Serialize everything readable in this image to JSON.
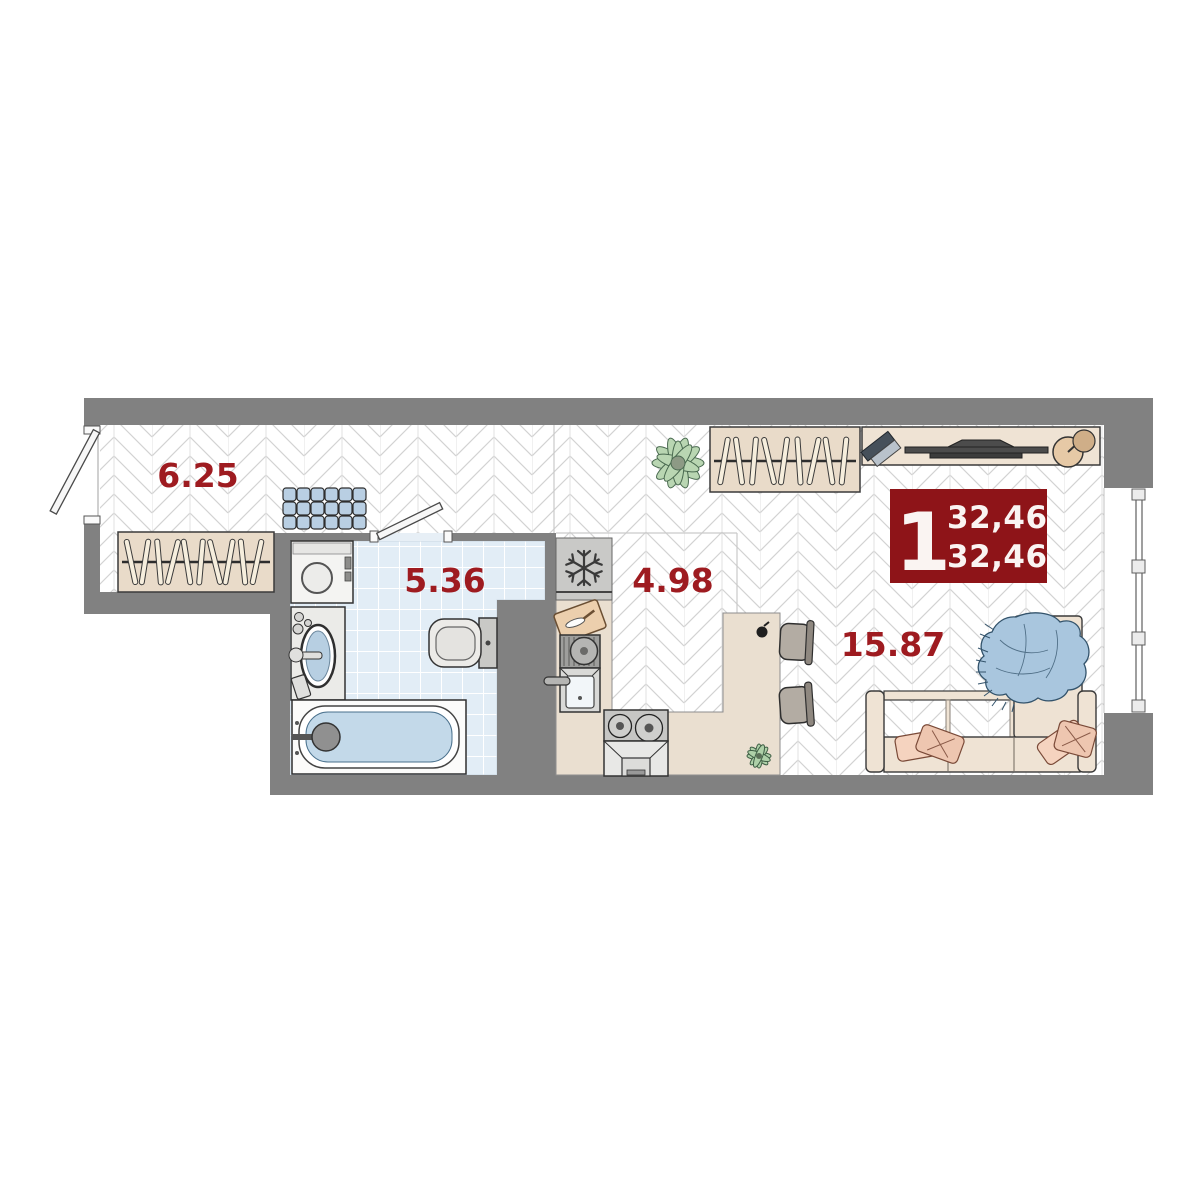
{
  "plan": {
    "title": "Studio apartment floor plan",
    "badge": {
      "rooms_count": "1",
      "total_area": "32,46",
      "living_area": "32,46"
    },
    "rooms": [
      {
        "name": "hallway",
        "area": "6.25"
      },
      {
        "name": "bathroom",
        "area": "5.36"
      },
      {
        "name": "kitchen",
        "area": "4.98"
      },
      {
        "name": "living-room",
        "area": "15.87"
      }
    ],
    "icons": [
      "snowflake-icon",
      "hanger-icon",
      "plant-icon",
      "tv-icon",
      "window-icon",
      "door-icon"
    ],
    "colors": {
      "wall": "#818181",
      "area_label": "#9e1b20",
      "badge_bg": "#8e1418",
      "badge_text": "#faf4f2",
      "tile": "#e2edf6",
      "furniture_beige": "#eadfd0",
      "water_blue": "#b9d0e4",
      "plant_green": "#b9d6b2"
    }
  }
}
